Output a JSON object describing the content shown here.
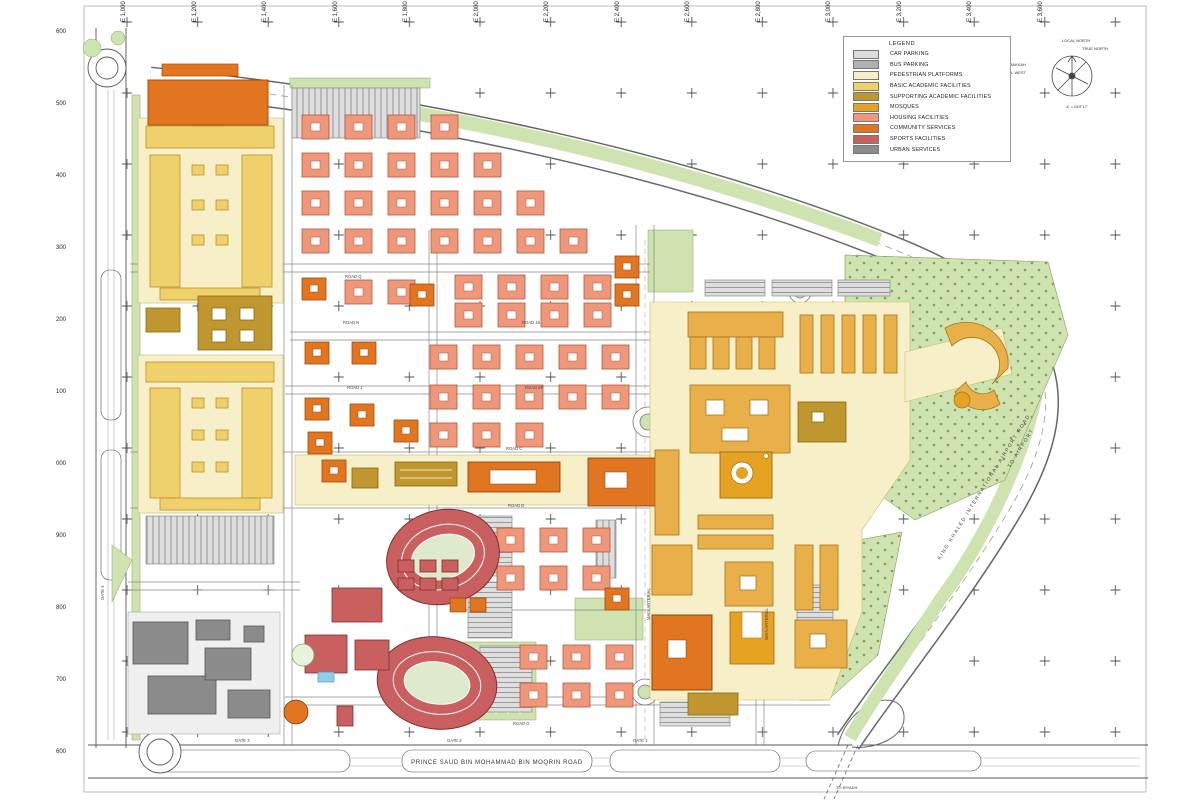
{
  "palette": {
    "car_parking": "#dcdcdc",
    "bus_parking": "#b0b0b0",
    "pedestrian": "#f6efc8",
    "basic_academic": "#f0d06a",
    "supporting_academic": "#c0962e",
    "mosques": "#e5a223",
    "housing": "#ef977b",
    "community": "#e2751f",
    "sports": "#c9605f",
    "urban": "#8b8b8b",
    "green": "#cfe3b0",
    "green_dark": "#86a75e",
    "core_gold": "#e9b049",
    "pool_blue": "#8fd0e8"
  },
  "legend": {
    "title": "LEGEND",
    "items": [
      {
        "label": "CAR PARKING",
        "color": "car_parking"
      },
      {
        "label": "BUS PARKING",
        "color": "bus_parking"
      },
      {
        "label": "PEDESTRIAN PLATFORMS",
        "color": "pedestrian"
      },
      {
        "label": "BASIC ACADEMIC FACILITIES",
        "color": "basic_academic"
      },
      {
        "label": "SUPPORTING ACADEMIC FACILITIES",
        "color": "supporting_academic"
      },
      {
        "label": "MOSQUES",
        "color": "mosques"
      },
      {
        "label": "HOUSING FACILITIES",
        "color": "housing"
      },
      {
        "label": "COMMUNITY SERVICES",
        "color": "community"
      },
      {
        "label": "SPORTS FACILITIES",
        "color": "sports"
      },
      {
        "label": "URBAN SERVICES",
        "color": "urban"
      }
    ]
  },
  "compass": {
    "local_north": "LOCAL NORTH",
    "true_north": "TRUE NORTH",
    "makkah": "MAKKAH",
    "local_west": "LOCAL WEST",
    "angle": "∠ = 043°17'"
  },
  "grid": {
    "eastings": [
      "E 1,000",
      "E 1,200",
      "E 1,400",
      "E 1,600",
      "E 1,800",
      "E 2,000",
      "E 2,200",
      "E 2,400",
      "E 2,600",
      "E 2,800",
      "E 3,000",
      "E 3,200",
      "E 3,400",
      "E 3,600"
    ],
    "northings": [
      "600",
      "500",
      "400",
      "300",
      "200",
      "100",
      "000",
      "900",
      "800",
      "700",
      "600"
    ]
  },
  "roads": {
    "south_road": "PRINCE SAUD BIN MOHAMMAD BIN MOQRIN ROAD",
    "airport_road": "KING KHALED INTERNATIONAL AIRPORT ROAD",
    "to_airport": "TO AIRPORT",
    "to_riyadh": "TO RIYADH",
    "gates": [
      "GATE 1",
      "GATE 2",
      "GATE 3",
      "GATE 4"
    ],
    "street_labels": [
      "ROAD Q",
      "ROAD N",
      "ROAD 16",
      "ROAD J",
      "ROAD 8P",
      "ROAD C",
      "ROAD D",
      "ROAD G",
      "MAIN ARTERIAL",
      "MAIN ARTERIAL"
    ]
  }
}
